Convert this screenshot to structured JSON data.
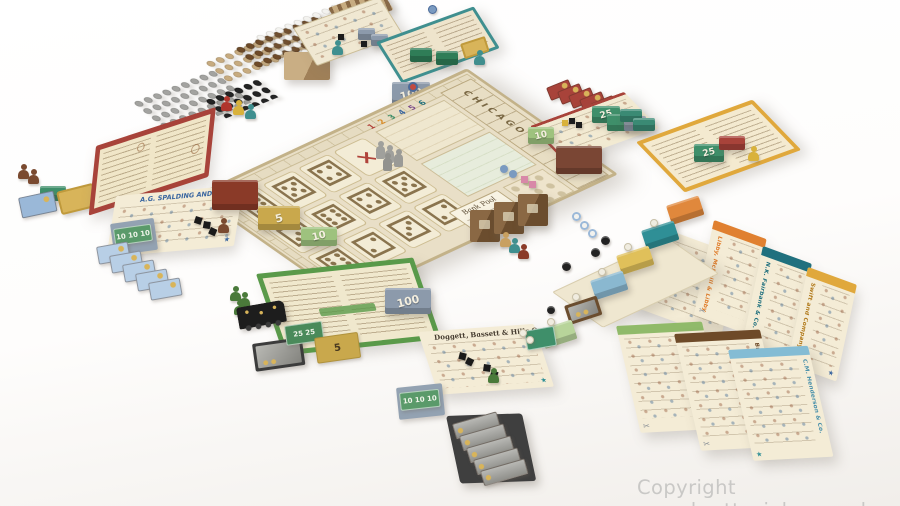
{
  "photo": {
    "subject": "Board game City of the Big Shoulders fully set up on a white background",
    "watermark": "Copyright www.brettspiel-news.de"
  },
  "board": {
    "bank_pool": "Bank Pool",
    "stock_track": "CHICAGO",
    "phases": [
      "1",
      "2",
      "3",
      "4",
      "5",
      "6"
    ],
    "dice": [
      "⚅",
      "⚄",
      "⚃",
      "×",
      "⚂",
      "⚅",
      "⚃",
      "⚄",
      "⚅",
      "⚁",
      "⚂",
      "⚁"
    ]
  },
  "money": {
    "hundred": "100",
    "twentyfive": "25",
    "ten": "10",
    "five": "5",
    "ten_notes": "10 10 10",
    "twentyfive_notes": "25 25"
  },
  "companies": {
    "spalding": "A.G. Spalding and Bros",
    "doggett": "Doggett, Bassett & Hills Co.",
    "libby": "Libby, McNeill & Libby",
    "fairbank": "N.K. Fairbank & Co.",
    "swift": "Swift and Company",
    "anglo": "Anglo-American Provision Co.",
    "brunswick": "Brunswick-Balke-Collender Co.",
    "henderson": "C.M. Henderson & Co."
  },
  "icons": {
    "scissors": "✂",
    "star": "★"
  }
}
